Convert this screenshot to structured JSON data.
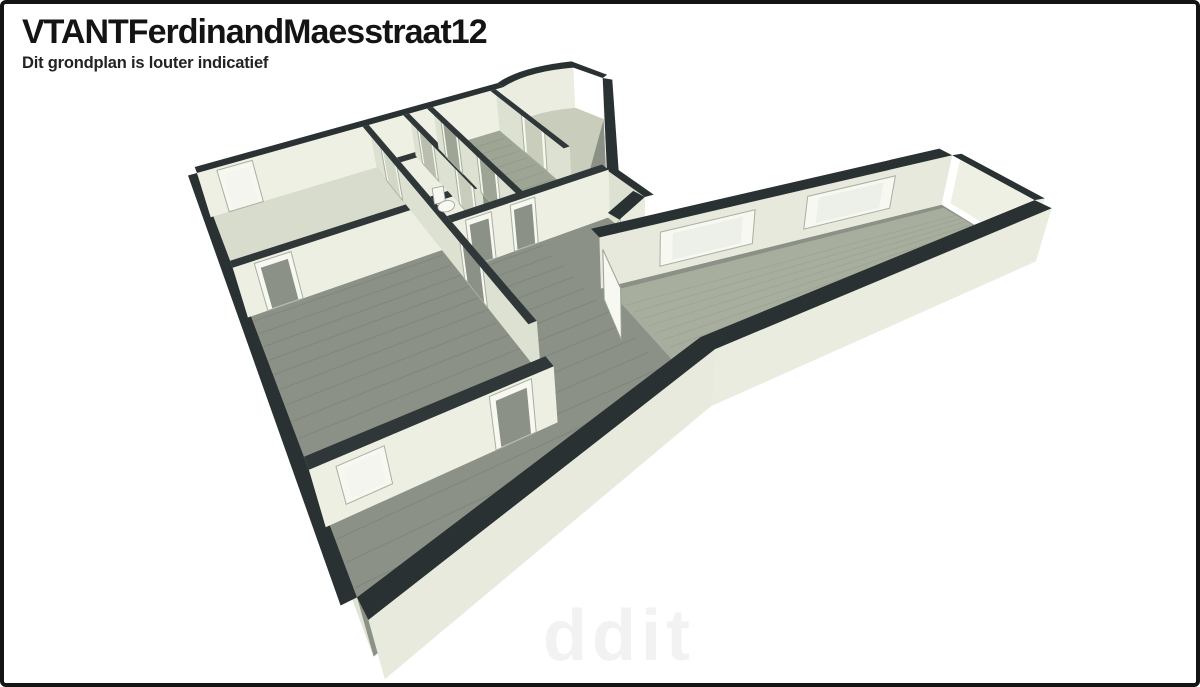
{
  "header": {
    "title": "VTANTFerdinandMaesstraat12",
    "subtitle": "Dit grondplan is louter indicatief"
  },
  "watermark": "ddit",
  "figure": {
    "type": "3d-floorplan-render",
    "description": "Perspective 3D floor plan of an apartment, viewed from above. A main block with several rooms on the left, a central hallway with WC, a curved-wall room at the top, a large wood-floored living space at the bottom, and a long narrow wing with two windows extending to the upper right. Dark wall caps, cream wall faces, grey-brown wood floors, white door and window frames.",
    "rooms": [
      "room-northwest",
      "room-west-middle",
      "room-southwest",
      "wc",
      "hallway-north",
      "hallway-central",
      "curved-room-north",
      "room-northeast",
      "living-area",
      "wing-corridor"
    ]
  },
  "colors": {
    "background": "#ffffff",
    "border": "#141414",
    "text": "#141414",
    "wall_cap": "#2a3132",
    "wall_cap_inner": "#2f3738",
    "wall_face_bright": "#eef0e4",
    "wall_face": "#e6e9db",
    "wall_face_shaded": "#dde1d2",
    "floor_wood": "#8b9186",
    "floor_light": "#d8dccd",
    "door_white": "#f7f8f2",
    "glass": "#edf0e8",
    "frame_stroke": "#a9afa0"
  }
}
